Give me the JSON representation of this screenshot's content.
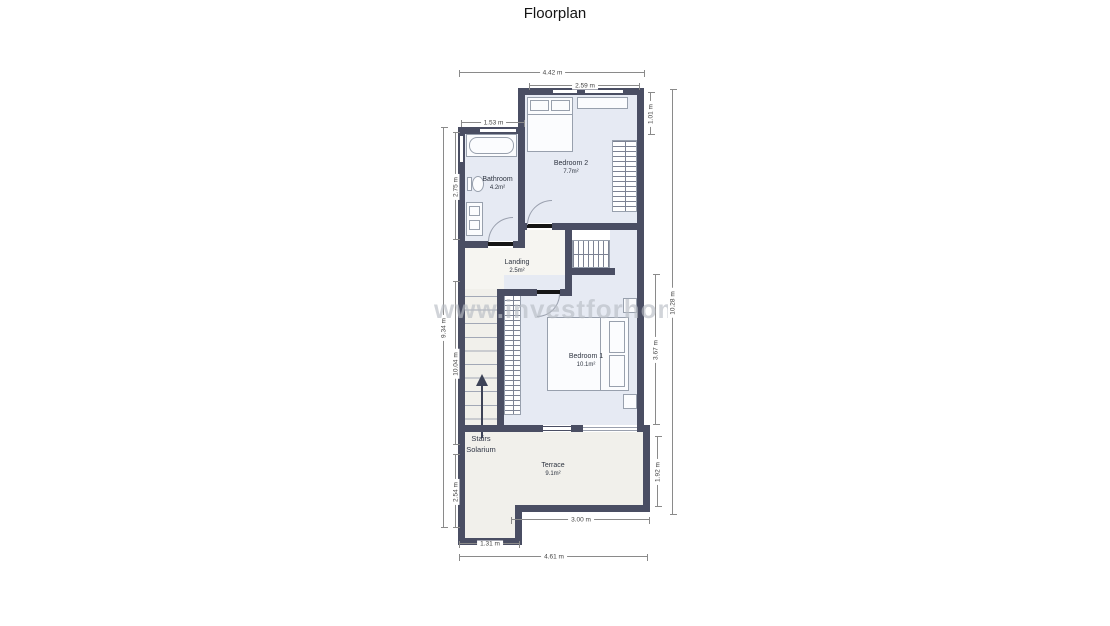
{
  "title": "Floorplan",
  "watermark": "www.investforhome.com",
  "rooms": {
    "bathroom": {
      "name": "Bathroom",
      "area": "4.2m²"
    },
    "bedroom2": {
      "name": "Bedroom 2",
      "area": "7.7m²"
    },
    "landing": {
      "name": "Landing",
      "area": "2.5m²"
    },
    "bedroom1": {
      "name": "Bedroom 1",
      "area": "10.1m²"
    },
    "terrace": {
      "name": "Terrace",
      "area": "9.1m²"
    }
  },
  "stairs": {
    "line1": "Stairs",
    "line2": "Solarium"
  },
  "dimensions": {
    "top_overall": "4.42 m",
    "top_bedroom2": "2.59 m",
    "top_bathroom": "1.53 m",
    "left_overall": "9.34 m",
    "left_bathroom": "2.75 m",
    "left_stairwell": "10.04 m",
    "left_lower": "2.54 m",
    "right_bedroom2": "1.01 m",
    "right_overall": "10.28 m",
    "right_bedroom1": "3.67 m",
    "right_terrace": "1.92 m",
    "bottom_terrace": "3.00 m",
    "bottom_left": "1.31 m",
    "bottom_overall": "4.61 m"
  },
  "colors": {
    "wall": "#4a4e63",
    "room_fill": "#e6eaf3",
    "hall_fill": "#f6f5f1",
    "terrace_fill": "#f1f0eb",
    "dimension_line": "#8a8a8a",
    "door_leaf": "#161616",
    "stairs_arrow": "#3d4357",
    "watermark_gray": "#b9bdc5"
  }
}
